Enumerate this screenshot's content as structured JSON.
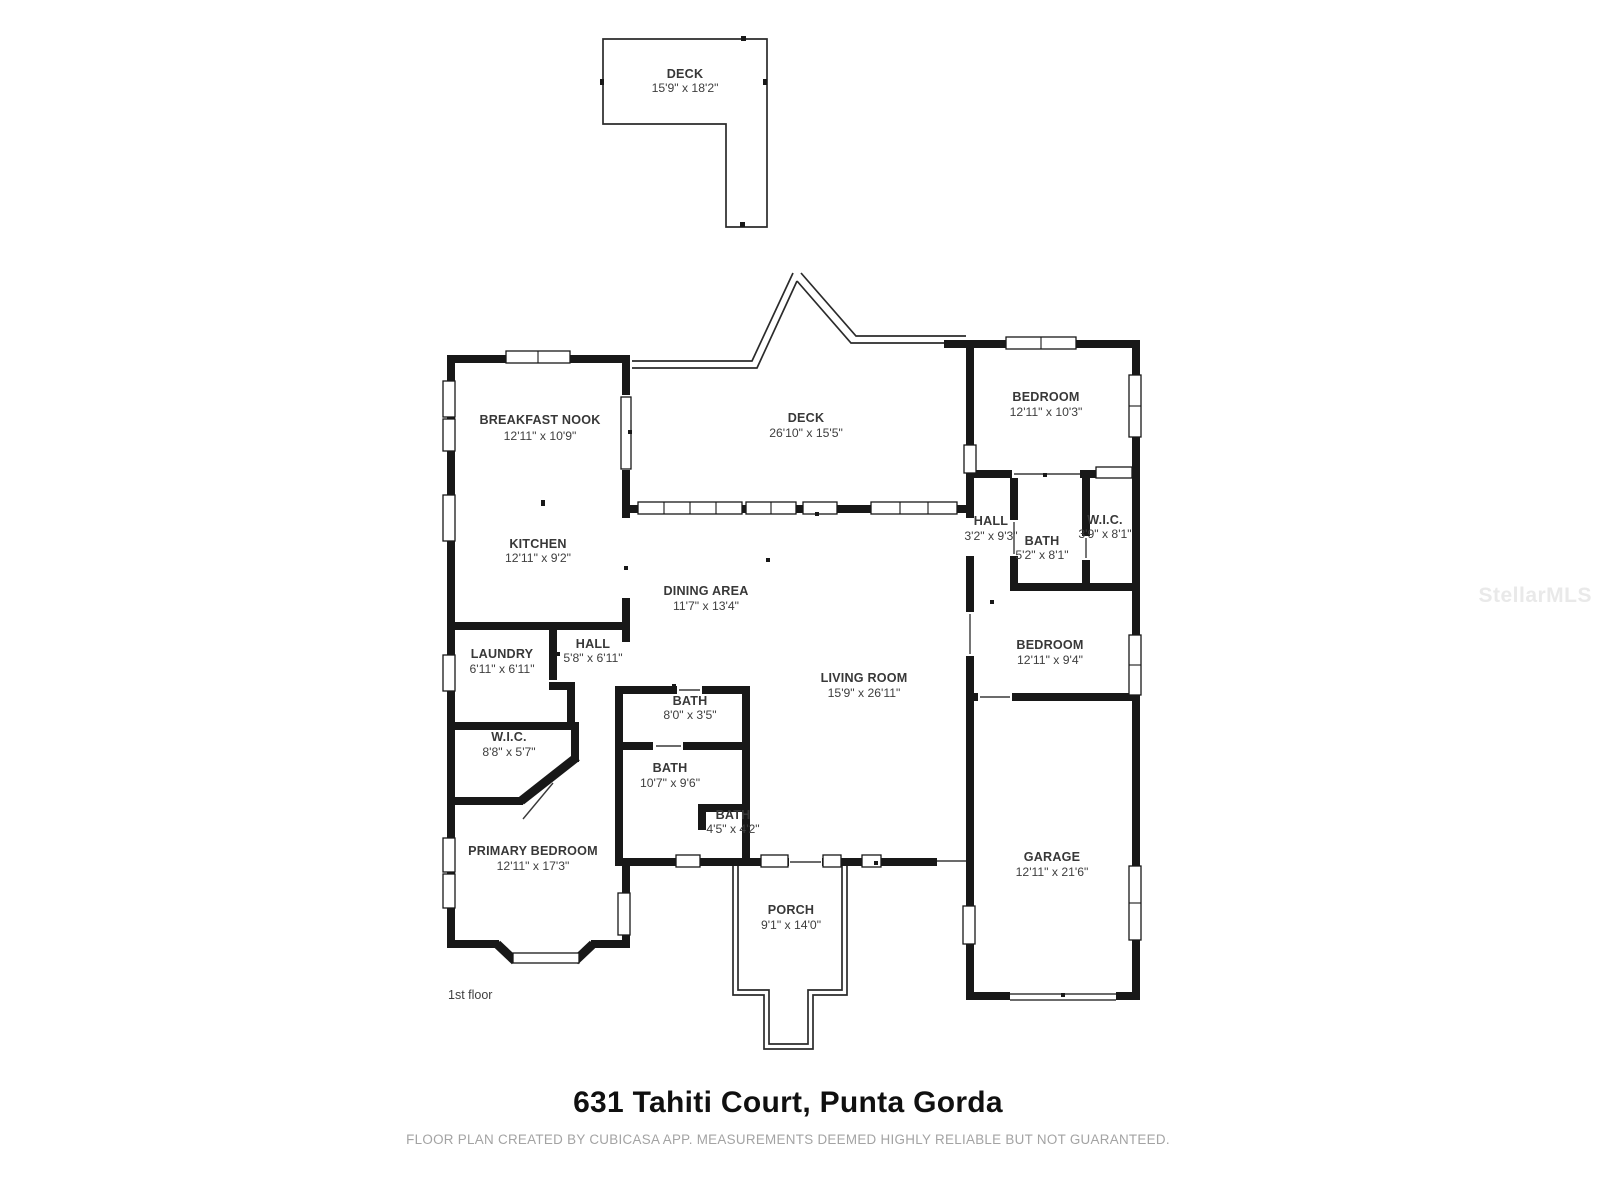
{
  "annotations": {
    "floor_label": "1st floor",
    "title": "631 Tahiti Court, Punta Gorda",
    "disclaimer": "FLOOR PLAN CREATED BY CUBICASA APP. MEASUREMENTS DEEMED HIGHLY RELIABLE BUT NOT GUARANTEED.",
    "watermark": "StellarMLS"
  },
  "colors": {
    "wall": "#181818",
    "room_label": "#383838",
    "muted_text": "#a3a3a3",
    "watermark": "#e9e9e9",
    "background": "#ffffff"
  },
  "rooms": {
    "deck_upper": {
      "name": "DECK",
      "dims": "15'9\" x 18'2\""
    },
    "breakfast_nook": {
      "name": "BREAKFAST NOOK",
      "dims": "12'11\" x 10'9\""
    },
    "deck_main": {
      "name": "DECK",
      "dims": "26'10\" x 15'5\""
    },
    "bedroom_ne": {
      "name": "BEDROOM",
      "dims": "12'11\" x 10'3\""
    },
    "kitchen": {
      "name": "KITCHEN",
      "dims": "12'11\" x 9'2\""
    },
    "hall_east": {
      "name": "HALL",
      "dims": "3'2\" x 9'3\""
    },
    "bath_east": {
      "name": "BATH",
      "dims": "5'2\" x 8'1\""
    },
    "wic_east": {
      "name": "W.I.C.",
      "dims": "3'9\" x 8'1\""
    },
    "dining_area": {
      "name": "DINING AREA",
      "dims": "11'7\" x 13'4\""
    },
    "bedroom_e": {
      "name": "BEDROOM",
      "dims": "12'11\" x 9'4\""
    },
    "laundry": {
      "name": "LAUNDRY",
      "dims": "6'11\" x 6'11\""
    },
    "hall_west": {
      "name": "HALL",
      "dims": "5'8\" x 6'11\""
    },
    "living_room": {
      "name": "LIVING ROOM",
      "dims": "15'9\" x 26'11\""
    },
    "bath_center": {
      "name": "BATH",
      "dims": "8'0\" x 3'5\""
    },
    "wic_west": {
      "name": "W.I.C.",
      "dims": "8'8\" x 5'7\""
    },
    "bath_main": {
      "name": "BATH",
      "dims": "10'7\" x 9'6\""
    },
    "bath_small": {
      "name": "BATH",
      "dims": "4'5\" x 4'2\""
    },
    "primary_bedroom": {
      "name": "PRIMARY BEDROOM",
      "dims": "12'11\" x 17'3\""
    },
    "garage": {
      "name": "GARAGE",
      "dims": "12'11\" x 21'6\""
    },
    "porch": {
      "name": "PORCH",
      "dims": "9'1\" x 14'0\""
    }
  }
}
